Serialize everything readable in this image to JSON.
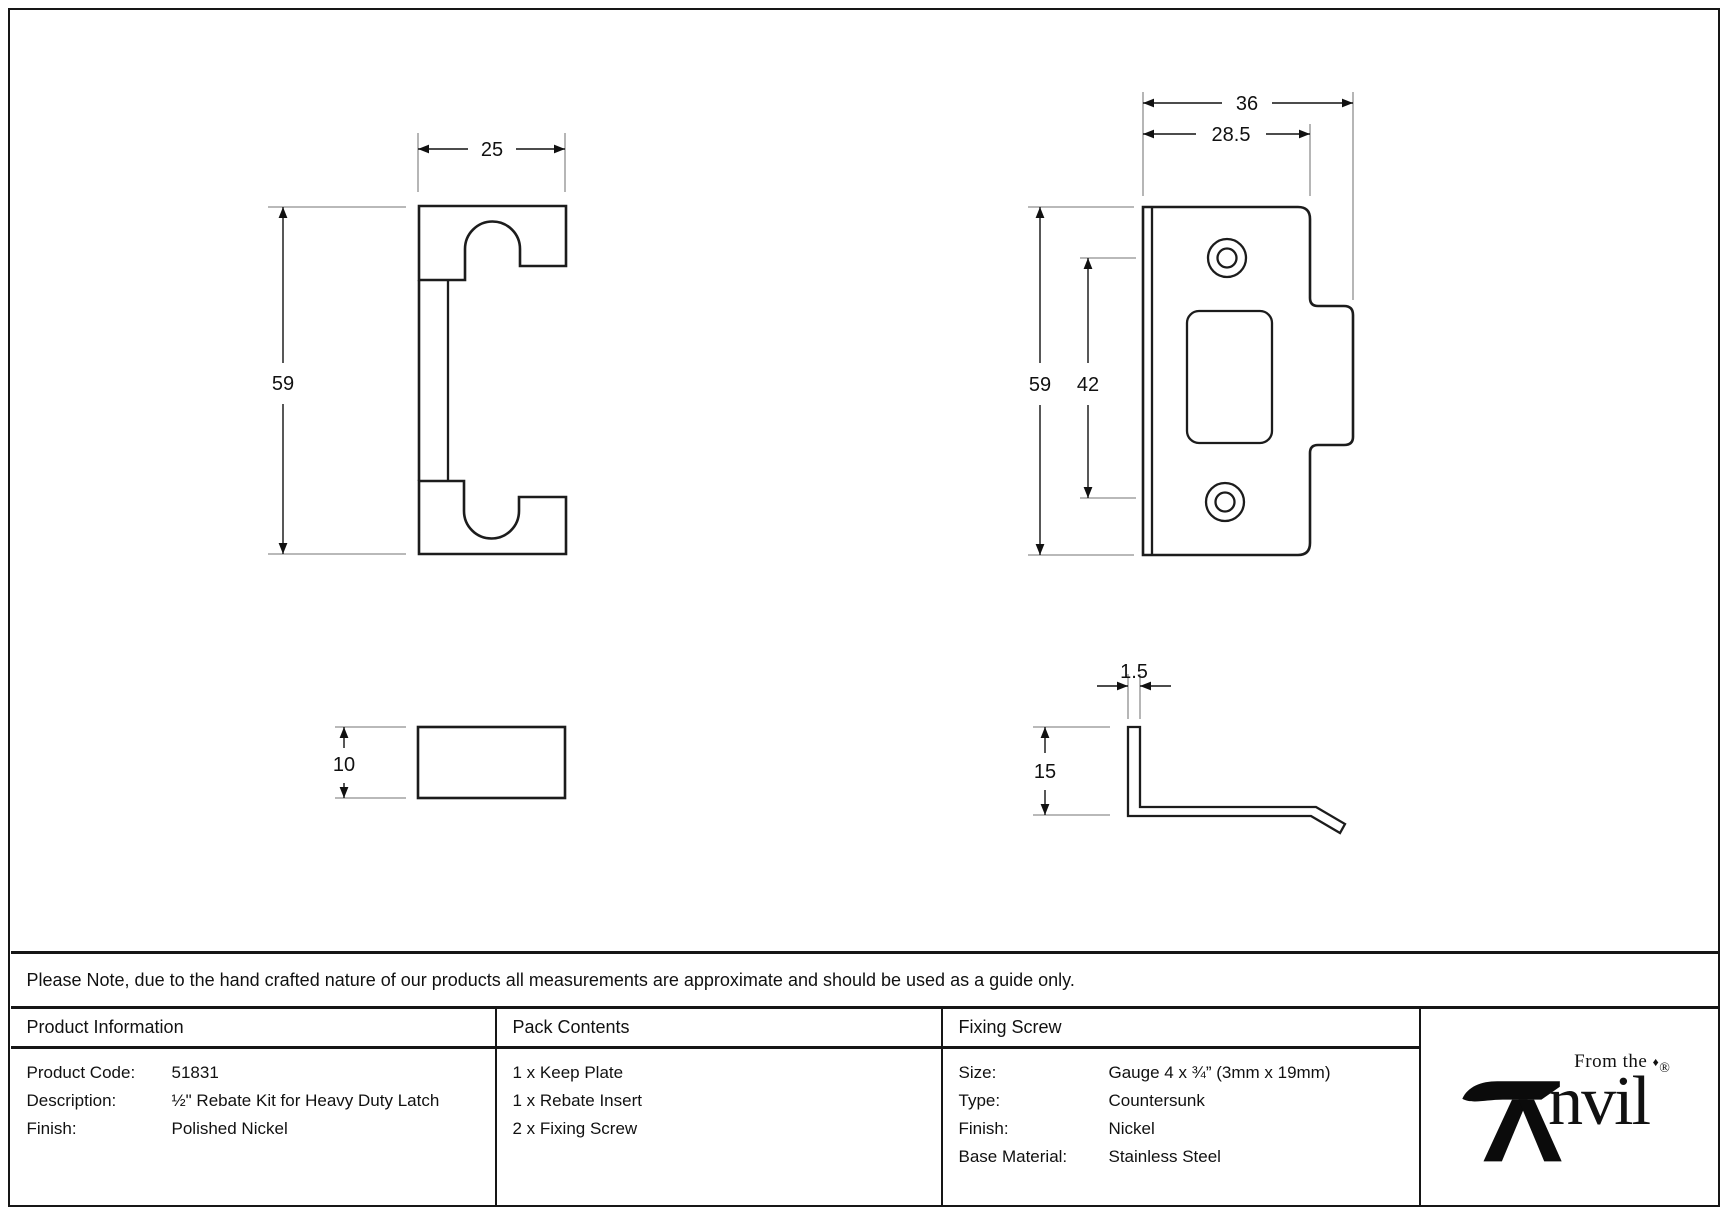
{
  "note": "Please Note, due to the hand crafted nature of our products all measurements are approximate and should be used as a guide only.",
  "drawings": {
    "insert_front": {
      "width_label": "25",
      "height_label": "59"
    },
    "insert_side": {
      "thickness_label": "10"
    },
    "keep_front": {
      "overall_width_label": "36",
      "plate_width_label": "28.5",
      "height_label": "59",
      "screw_spacing_label": "42"
    },
    "keep_side": {
      "thickness_label": "1.5",
      "lip_height_label": "15"
    }
  },
  "table": {
    "product_information": {
      "header": "Product Information",
      "rows": [
        {
          "label": "Product Code:",
          "value": "51831"
        },
        {
          "label": "Description:",
          "value": "½\" Rebate Kit for Heavy Duty Latch"
        },
        {
          "label": "Finish:",
          "value": "Polished Nickel"
        }
      ]
    },
    "pack_contents": {
      "header": "Pack Contents",
      "items": [
        "1 x Keep Plate",
        "1 x Rebate Insert",
        "2 x Fixing Screw"
      ]
    },
    "fixing_screw": {
      "header": "Fixing Screw",
      "rows": [
        {
          "label": "Size:",
          "value": "Gauge 4 x ¾” (3mm x 19mm)"
        },
        {
          "label": "Type:",
          "value": "Countersunk"
        },
        {
          "label": "Finish:",
          "value": "Nickel"
        },
        {
          "label": "Base Material:",
          "value": "Stainless Steel"
        }
      ]
    }
  },
  "logo": {
    "tagline": "From the",
    "diamond": "♦",
    "brand": "Anvil",
    "brand_tail": "nvil",
    "registered": "®"
  }
}
